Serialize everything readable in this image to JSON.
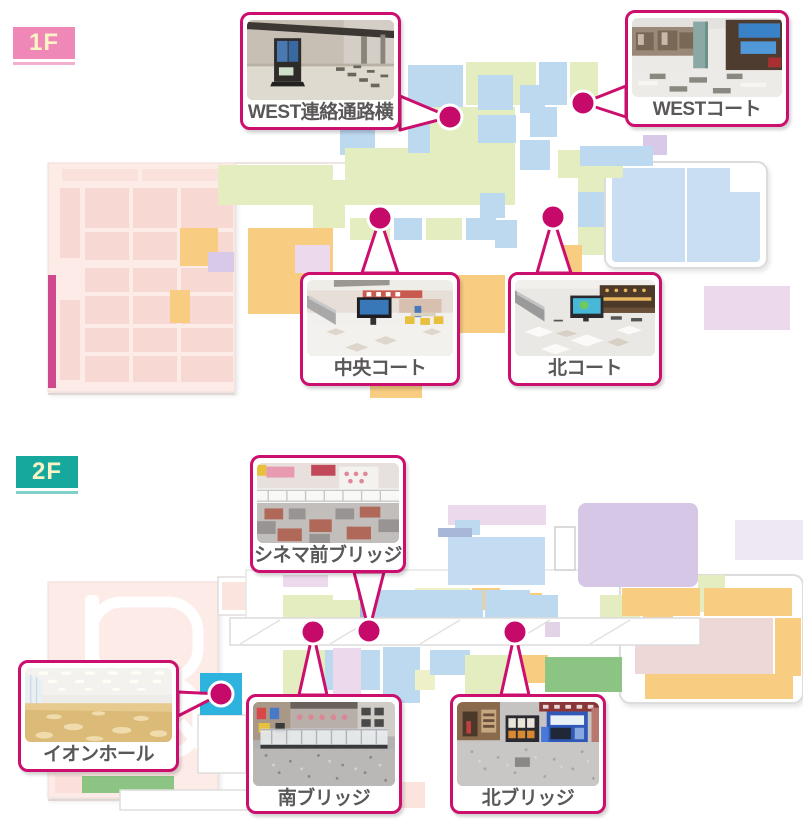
{
  "palette": {
    "accent_magenta": "#CC0F6E",
    "dot_magenta": "#C60A6A",
    "floor1_badge": "#EF87B7",
    "floor1_underline": "#F2AFD0",
    "floor2_badge": "#16A89D",
    "floor2_underline": "#7ED0C9",
    "badge_text": "#FAF3C6",
    "label_text": "#5A5757",
    "map_pink": "#FDEBE7",
    "map_green": "#E3EDC0",
    "map_blue": "#BDD9F0",
    "map_orange": "#F8CD82",
    "map_lavender": "#D7C7E7",
    "map_cyan": "#2EB3DE"
  },
  "floor1": {
    "badge": "1F",
    "callouts": {
      "west_passage": {
        "label": "WEST連絡通路横"
      },
      "west_court": {
        "label": "WESTコート"
      },
      "central_court": {
        "label": "中央コート"
      },
      "north_court": {
        "label": "北コート"
      }
    }
  },
  "floor2": {
    "badge": "2F",
    "callouts": {
      "cinema_bridge": {
        "label": "シネマ前ブリッジ"
      },
      "aeon_hall": {
        "label": "イオンホール"
      },
      "south_bridge": {
        "label": "南ブリッジ"
      },
      "north_bridge": {
        "label": "北ブリッジ"
      }
    }
  }
}
